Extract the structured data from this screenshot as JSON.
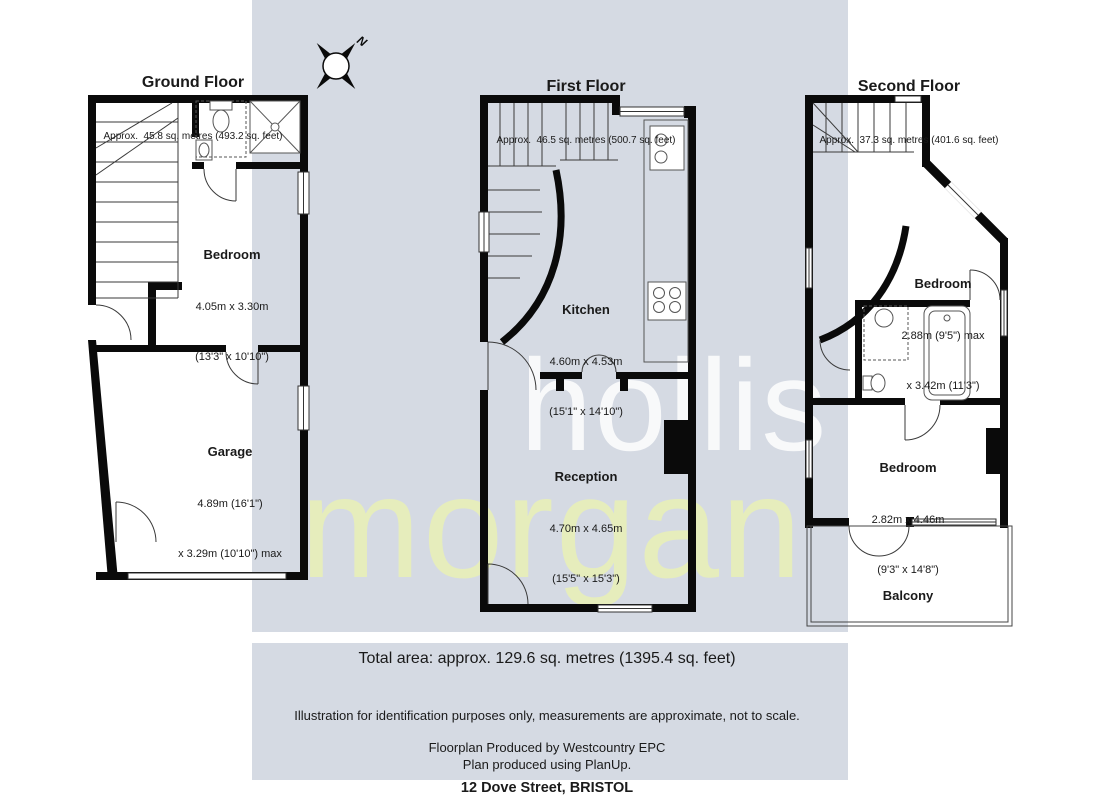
{
  "watermark": {
    "line1": "hollis",
    "line2": "morgan"
  },
  "compass": {
    "label": "N"
  },
  "floors": [
    {
      "title": "Ground Floor",
      "area": "Approx.  45.8 sq. metres (493.2 sq. feet)",
      "rooms": [
        {
          "name": "Bedroom",
          "dim1": "4.05m x 3.30m",
          "dim2": "(13'3\" x 10'10\")"
        },
        {
          "name": "Garage",
          "dim1": "4.89m (16'1\")",
          "dim2": "x 3.29m (10'10\") max"
        }
      ]
    },
    {
      "title": "First Floor",
      "area": "Approx.  46.5 sq. metres (500.7 sq. feet)",
      "rooms": [
        {
          "name": "Kitchen",
          "dim1": "4.60m x 4.53m",
          "dim2": "(15'1\" x 14'10\")"
        },
        {
          "name": "Reception",
          "dim1": "4.70m x 4.65m",
          "dim2": "(15'5\" x 15'3\")"
        }
      ]
    },
    {
      "title": "Second Floor",
      "area": "Approx.  37.3 sq. metres (401.6 sq. feet)",
      "rooms": [
        {
          "name": "Bedroom",
          "dim1": "2.88m (9'5\") max",
          "dim2": "x 3.42m (11'3\")"
        },
        {
          "name": "Bedroom",
          "dim1": "2.82m x 4.46m",
          "dim2": "(9'3\" x 14'8\")"
        },
        {
          "name": "Balcony",
          "dim1": "",
          "dim2": ""
        }
      ]
    }
  ],
  "footer": {
    "total_area": "Total area: approx. 129.6 sq. metres (1395.4 sq. feet)",
    "disclaimer": "Illustration for identification purposes only, measurements are approximate, not to scale.",
    "produced_by": "Floorplan Produced by Westcountry EPC",
    "produced_with": "Plan produced using PlanUp.",
    "address": "12 Dove Street, BRISTOL"
  },
  "colors": {
    "panel": "#d5dae3",
    "wall": "#0a0a0a",
    "morgan": "#e7efba"
  }
}
